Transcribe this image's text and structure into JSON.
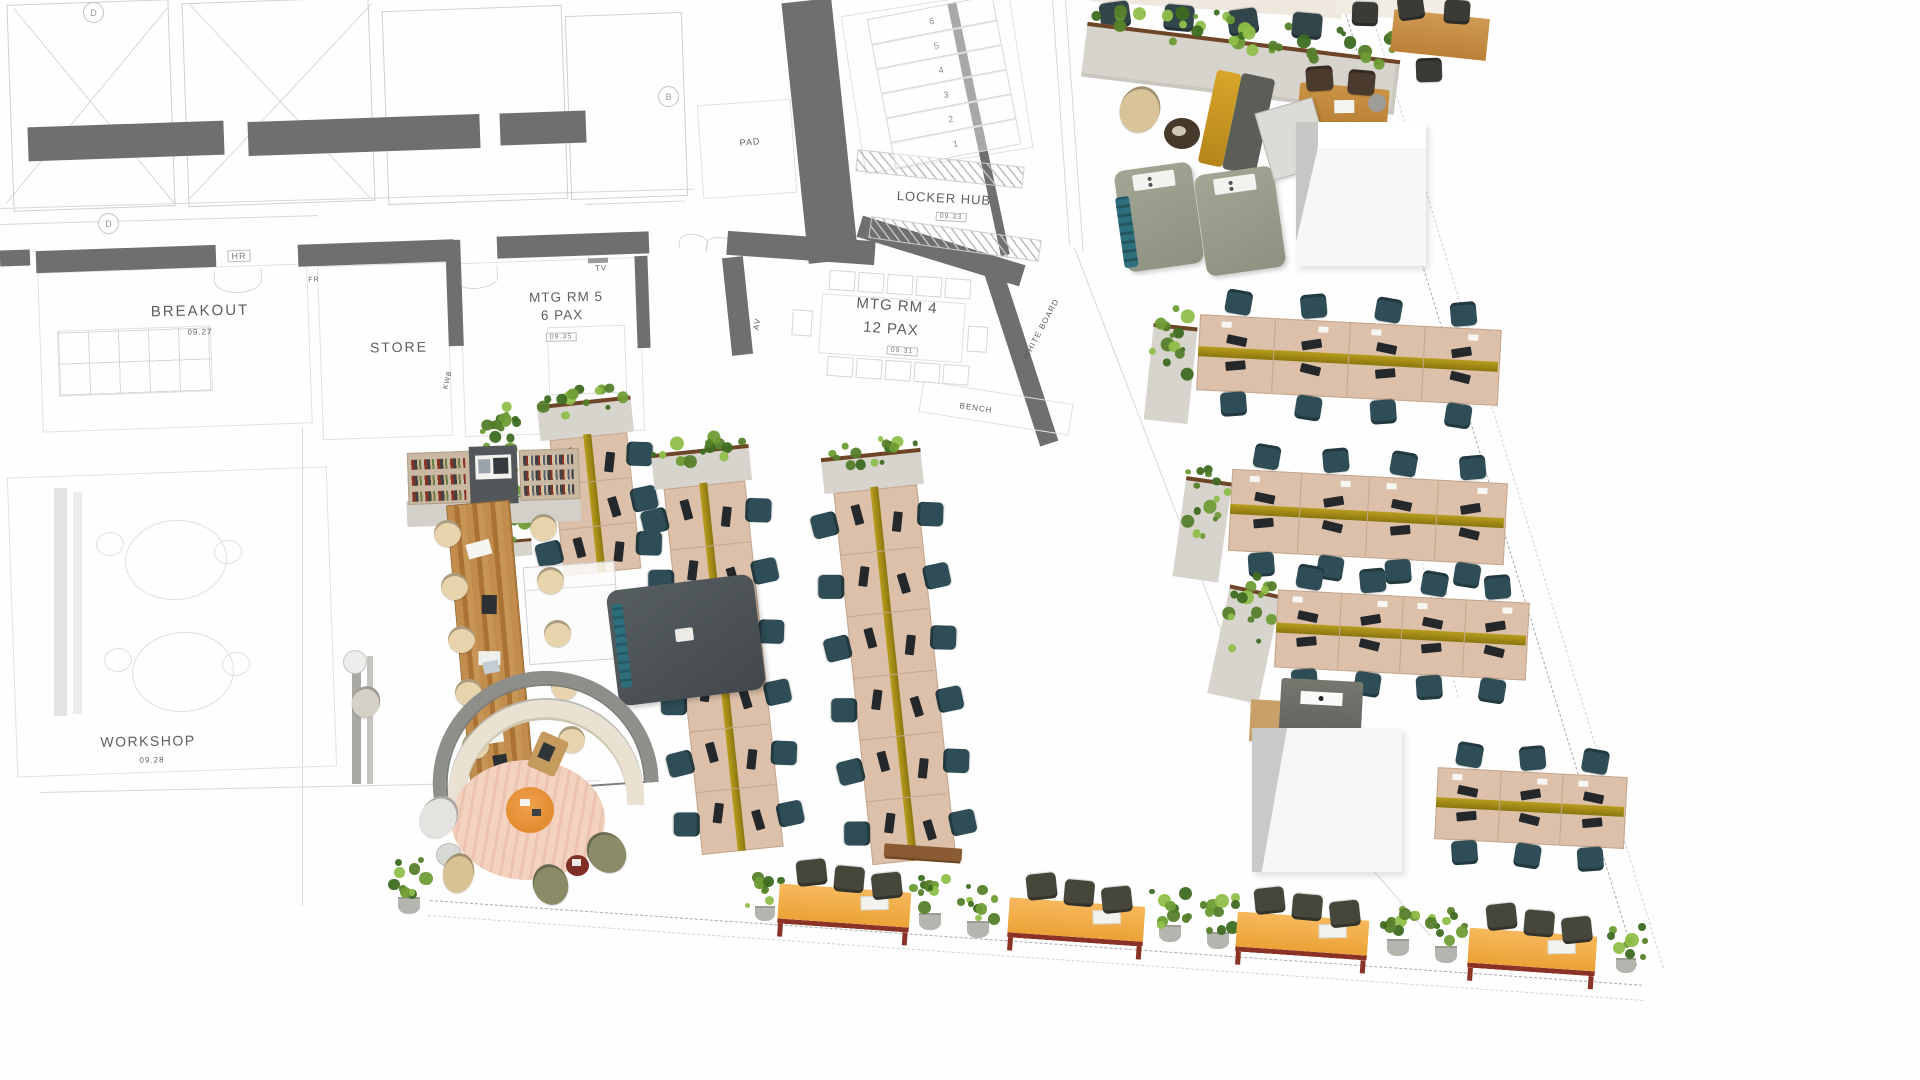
{
  "colors": {
    "wall": "#6f6f6f",
    "sketch": "#cfcfcf",
    "desk": "#dcc0a9",
    "deskEdge": "#c4a68e",
    "olive1": "#b89d1e",
    "olive2": "#8a760e",
    "chairTeal": "#2e4d56",
    "chairDark": "#46463a",
    "chairCream": "#e7d3ac",
    "chairOlive": "#8b8b68",
    "wood": "#b9854a",
    "planterBox": "#d7d4cd",
    "planterRim": "#6f4527",
    "leaves": [
      "#3e6b21",
      "#567f2b",
      "#6f9c35",
      "#8fbf49"
    ],
    "orange": "#f0a844",
    "maroon": "#8a3226",
    "rug": "#f3d2c0",
    "rugStripe": "#ecc3b0",
    "accentYellow": "#c8951a",
    "screenGrey": "#8e8e8a",
    "cream": "#e9e2d2",
    "podTeal": "#2e6f7e",
    "boothDark": "#42484b",
    "label": "#5e5e5e"
  },
  "floorplan": {
    "rooms": [
      {
        "id": "breakout",
        "name": "BREAKOUT",
        "number": "09.27"
      },
      {
        "id": "store",
        "name": "STORE"
      },
      {
        "id": "mtg-rm-5",
        "name": "MTG RM 5",
        "capacity": "6 PAX",
        "number": "09.35"
      },
      {
        "id": "mtg-rm-4",
        "name": "MTG RM 4",
        "capacity": "12 PAX",
        "number": "09.31"
      },
      {
        "id": "locker-hub",
        "name": "LOCKER HUB",
        "number": "09.33"
      },
      {
        "id": "workshop",
        "name": "WORKSHOP",
        "number": "09.28"
      }
    ],
    "wall_tags": [
      "HR",
      "FR",
      "TV",
      "KWB",
      "AV",
      "WHITE BOARD",
      "BENCH",
      "PAD"
    ],
    "grid_markers": [
      "D",
      "B"
    ],
    "stair_numbers": [
      "6",
      "5",
      "4",
      "3",
      "2",
      "1"
    ],
    "labels": [
      {
        "text": "BREAKOUT",
        "x": 200,
        "y": 311,
        "size": 15,
        "rot": -1,
        "sp": 2
      },
      {
        "text": "09.27",
        "x": 200,
        "y": 332,
        "size": 8,
        "rot": -1
      },
      {
        "text": "STORE",
        "x": 399,
        "y": 347,
        "size": 14,
        "rot": -1,
        "sp": 2
      },
      {
        "text": "MTG RM 5",
        "x": 566,
        "y": 297,
        "size": 13.5,
        "rot": -1,
        "sp": 1
      },
      {
        "text": "6 PAX",
        "x": 562,
        "y": 315,
        "size": 13.5,
        "rot": -1,
        "sp": 1
      },
      {
        "text": "09.35",
        "x": 561,
        "y": 337,
        "size": 7,
        "rot": -1,
        "boxed": true
      },
      {
        "text": "MTG RM 4",
        "x": 897,
        "y": 306,
        "size": 15,
        "rot": 4,
        "sp": 1
      },
      {
        "text": "12 PAX",
        "x": 891,
        "y": 329,
        "size": 15,
        "rot": 4,
        "sp": 1
      },
      {
        "text": "09.31",
        "x": 902,
        "y": 351,
        "size": 7,
        "rot": 4,
        "boxed": true
      },
      {
        "text": "LOCKER HUB",
        "x": 944,
        "y": 198,
        "size": 13,
        "rot": 3,
        "sp": 1
      },
      {
        "text": "09.33",
        "x": 951,
        "y": 217,
        "size": 7,
        "rot": 3,
        "boxed": true
      },
      {
        "text": "WORKSHOP",
        "x": 148,
        "y": 741,
        "size": 14,
        "rot": -1,
        "sp": 1.5
      },
      {
        "text": "09.28",
        "x": 152,
        "y": 760,
        "size": 8,
        "rot": -1
      },
      {
        "text": "HR",
        "x": 239,
        "y": 256,
        "size": 9,
        "rot": -2,
        "boxed": true
      },
      {
        "text": "FR",
        "x": 314,
        "y": 280,
        "size": 7,
        "rot": -2
      },
      {
        "text": "TV",
        "x": 601,
        "y": 268,
        "size": 8,
        "rot": -2
      },
      {
        "text": "KWB",
        "x": 448,
        "y": 380,
        "size": 7,
        "rot": -76
      },
      {
        "text": "AV",
        "x": 757,
        "y": 324,
        "size": 8,
        "rot": -78
      },
      {
        "text": "WHITE BOARD",
        "x": 1041,
        "y": 329,
        "size": 8,
        "rot": -62
      },
      {
        "text": "BENCH",
        "x": 976,
        "y": 408,
        "size": 8,
        "rot": 8
      },
      {
        "text": "PAD",
        "x": 750,
        "y": 142,
        "size": 9,
        "rot": -5
      },
      {
        "text": "D",
        "x": 108,
        "y": 223,
        "size": 9,
        "circled": true
      },
      {
        "text": "D",
        "x": 93,
        "y": 12,
        "size": 9,
        "circled": true
      },
      {
        "text": "B",
        "x": 668,
        "y": 96,
        "size": 9,
        "circled": true
      }
    ]
  }
}
